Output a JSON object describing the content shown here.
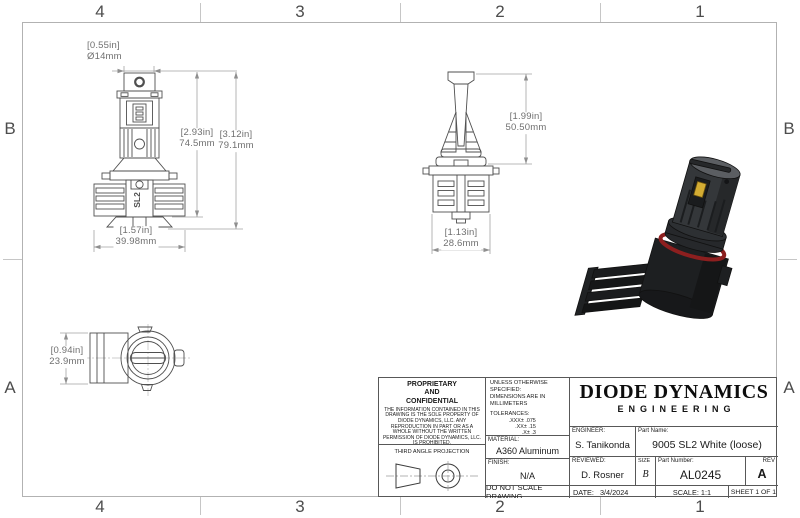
{
  "sheet": {
    "cols": [
      "4",
      "3",
      "2",
      "1"
    ],
    "rows": [
      "B",
      "A"
    ]
  },
  "views": {
    "front": {
      "logo": "SL2"
    }
  },
  "dimensions": {
    "cap_diameter": {
      "inches": "[0.55in]",
      "mm": "Ø14mm"
    },
    "body_height": {
      "inches": "[2.93in]",
      "mm": "74.5mm"
    },
    "overall_height": {
      "inches": "[3.12in]",
      "mm": "79.1mm"
    },
    "base_width": {
      "inches": "[1.57in]",
      "mm": "39.98mm"
    },
    "side_upper_height": {
      "inches": "[1.99in]",
      "mm": "50.50mm"
    },
    "side_body_width": {
      "inches": "[1.13in]",
      "mm": "28.6mm"
    },
    "top_view_height": {
      "inches": "[0.94in]",
      "mm": "23.9mm"
    }
  },
  "title_block": {
    "proprietary": {
      "heading": "PROPRIETARY\nAND\nCONFIDENTIAL",
      "body": "THE INFORMATION CONTAINED IN THIS DRAWING IS THE SOLE PROPERTY OF DIODE DYNAMICS, LLC.  ANY REPRODUCTION IN PART OR AS A WHOLE WITHOUT THE WRITTEN PERMISSION OF DIODE DYNAMICS, LLC. IS PROHIBITED.",
      "projection_label": "THIRD ANGLE PROJECTION"
    },
    "specs": {
      "unless": "UNLESS OTHERWISE SPECIFIED:",
      "units": "DIMENSIONS ARE IN MILLIMETERS",
      "tolerances_label": "TOLERANCES:",
      "tolerances": [
        ".XXX± .075",
        ".XX± .15",
        ".X± .3",
        "± .5",
        "ANG± 1"
      ],
      "material_label": "MATERIAL:",
      "material": "A360 Aluminum",
      "finish_label": "FINISH:",
      "finish": "N/A",
      "do_not_scale": "DO NOT SCALE DRAWING"
    },
    "company": {
      "name": "DIODE DYNAMICS",
      "division": "ENGINEERING"
    },
    "fields": {
      "engineer_label": "ENGINEER:",
      "engineer": "S. Tanikonda",
      "part_name_label": "Part Name:",
      "part_name": "9005 SL2 White (loose)",
      "reviewed_label": "REVIEWED:",
      "reviewed": "D. Rosner",
      "size_label": "SIZE",
      "size": "B",
      "part_number_label": "Part Number:",
      "part_number": "AL0245",
      "rev_label": "REV",
      "rev": "A",
      "date_label": "DATE:",
      "date": "3/4/2024",
      "scale": "SCALE: 1:1",
      "sheet": "SHEET 1 OF 1"
    }
  },
  "colors": {
    "chip_yellow": "#d3ac33",
    "oring_red": "#8d1f1f",
    "render_body": "#1d1f21",
    "edge_gray": "#4f4f4f",
    "dim_gray": "#a2a2a2"
  }
}
